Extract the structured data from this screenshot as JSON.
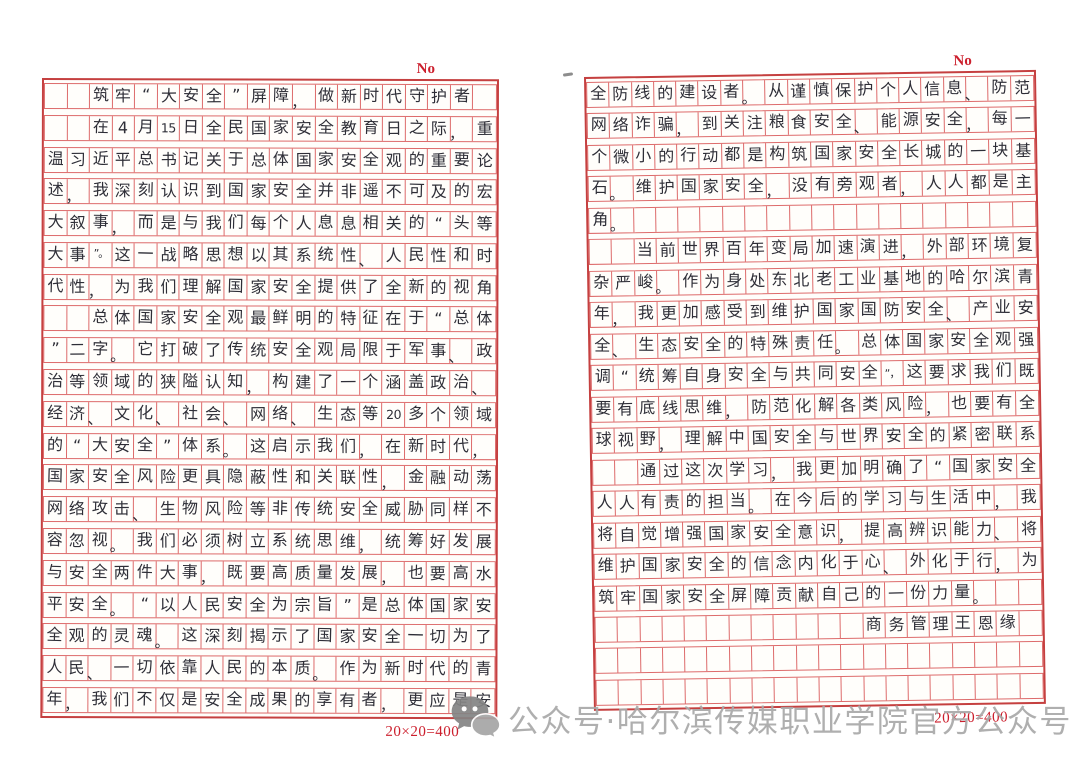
{
  "colors": {
    "grid_line": "#dd6b6b",
    "grid_border": "#c54040",
    "accent_red": "#cc1f2d",
    "ink": "#2e2e37",
    "watermark_gray": "#a9a9a9",
    "paper": "#fffefb"
  },
  "watermark": {
    "icon": "wechat-icon",
    "text": "公众号·哈尔滨传媒职业学院官方公众号"
  },
  "pages": [
    {
      "no_label": "No",
      "grid_label": "20×20=400",
      "lines": [
        "  筑牢“大安全”屏障，做新时代守护者",
        "  在4月15日全民国家安全教育日之际，重",
        "温习近平总书记关于总体国家安全观的重要论",
        "述，我深刻认识到国家安全并非遥不可及的宏",
        "大叙事，而是与我们每个人息息相关的“头等",
        "大事”。这一战略思想以其系统性、人民性和时",
        "代性，为我们理解国家安全提供了全新的视角",
        "  总体国家安全观最鲜明的特征在于“总体",
        "”二字。它打破了传统安全观局限于军事、政",
        "治等领域的狭隘认知，构建了一个涵盖政治、",
        "经济、文化、社会、网络、生态等20多个领域",
        "的“大安全”体系。这启示我们，在新时代，",
        "国家安全风险更具隐蔽性和关联性，金融动荡",
        "网络攻击、生物风险等非传统安全威胁同样不",
        "容忽视。我们必须树立系统思维，统筹好发展",
        "与安全两件大事，既要高质量发展，也要高水",
        "平安全。“以人民安全为宗旨”是总体国家安",
        "全观的灵魂。这深刻揭示了国家安全一切为了",
        "人民、一切依靠人民的本质。作为新时代的青",
        "年，我们不仅是安全成果的享有者，更应是安"
      ]
    },
    {
      "no_label": "No",
      "grid_label": "20×20=400",
      "lines": [
        "全防线的建设者。从谨慎保护个人信息、防范",
        "网络诈骗，到关注粮食安全、能源安全，每一",
        "个微小的行动都是构筑国家安全长城的一块基",
        "石。维护国家安全，没有旁观者，人人都是主",
        "角。",
        "  当前世界百年变局加速演进，外部环境复",
        "杂严峻。作为身处东北老工业基地的哈尔滨青",
        "年，我更加感受到维护国家国防安全、产业安",
        "全、生态安全的特殊责任。总体国家安全观强",
        "调“统筹自身安全与共同安全”，这要求我们既",
        "要有底线思维，防范化解各类风险，也要有全",
        "球视野，理解中国安全与世界安全的紧密联系",
        "  通过这次学习，我更加明确了“国家安全",
        "人人有责的担当。在今后的学习与生活中，我",
        "将自觉增强国家安全意识，提高辨识能力、将",
        "维护国家安全的信念内化于心、外化于行，为",
        "筑牢国家安全屏障贡献自己的一份力量。",
        "            商务管理王恩缘",
        "",
        ""
      ]
    }
  ]
}
